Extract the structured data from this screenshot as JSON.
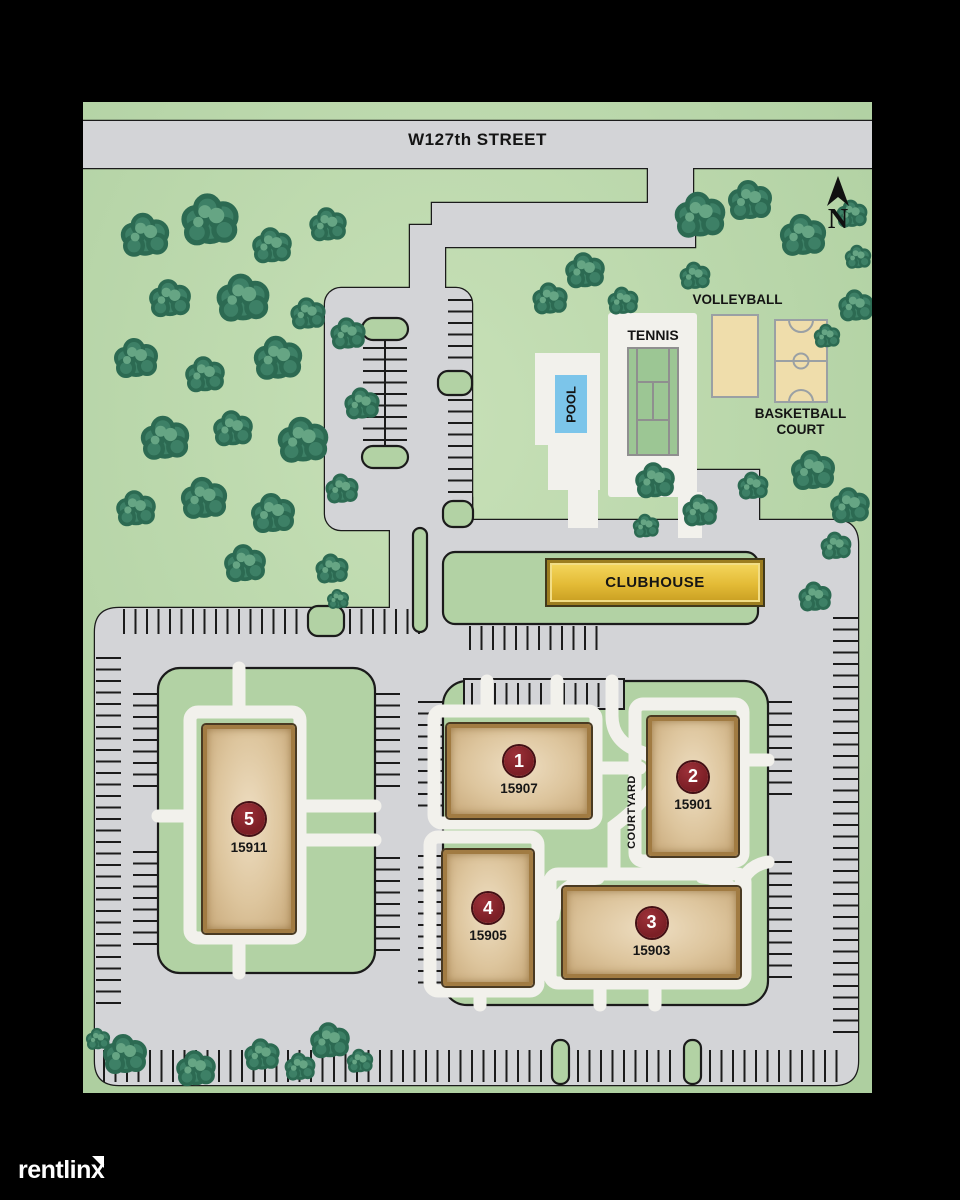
{
  "street": {
    "name": "W127th STREET"
  },
  "compass": {
    "north_label": "N"
  },
  "amenities": {
    "pool": "POOL",
    "tennis": "TENNIS",
    "volleyball": "VOLLEYBALL",
    "basketball_line1": "BASKETBALL",
    "basketball_line2": "COURT",
    "clubhouse": "CLUBHOUSE",
    "courtyard": "COURTYARD"
  },
  "buildings": [
    {
      "number": "1",
      "address": "15907"
    },
    {
      "number": "2",
      "address": "15901"
    },
    {
      "number": "3",
      "address": "15903"
    },
    {
      "number": "4",
      "address": "15905"
    },
    {
      "number": "5",
      "address": "15911"
    }
  ],
  "watermark": {
    "brand": "rentlinx"
  },
  "colors": {
    "background": "#000000",
    "map_green_light": "#c7e0b7",
    "map_green": "#aecfa0",
    "road_gray": "#d3d4d7",
    "street_gray": "#d9dadd",
    "outline": "#1b1b1b",
    "walkway_white": "#f2f1ec",
    "island_green": "#b2d2a4",
    "building_tan": "#ddc59d",
    "building_border": "#a17b42",
    "badge_red": "#7c1f26",
    "clubhouse_gold": "#e3bb36",
    "court_tan": "#efddab",
    "court_line_gray": "#9aa0a4",
    "tennis_green": "#9cc694",
    "pool_blue": "#7cc5ea",
    "tree_green": "#3d8066",
    "tree_outline": "#2c6a52",
    "tree_highlight": "#66a584"
  }
}
